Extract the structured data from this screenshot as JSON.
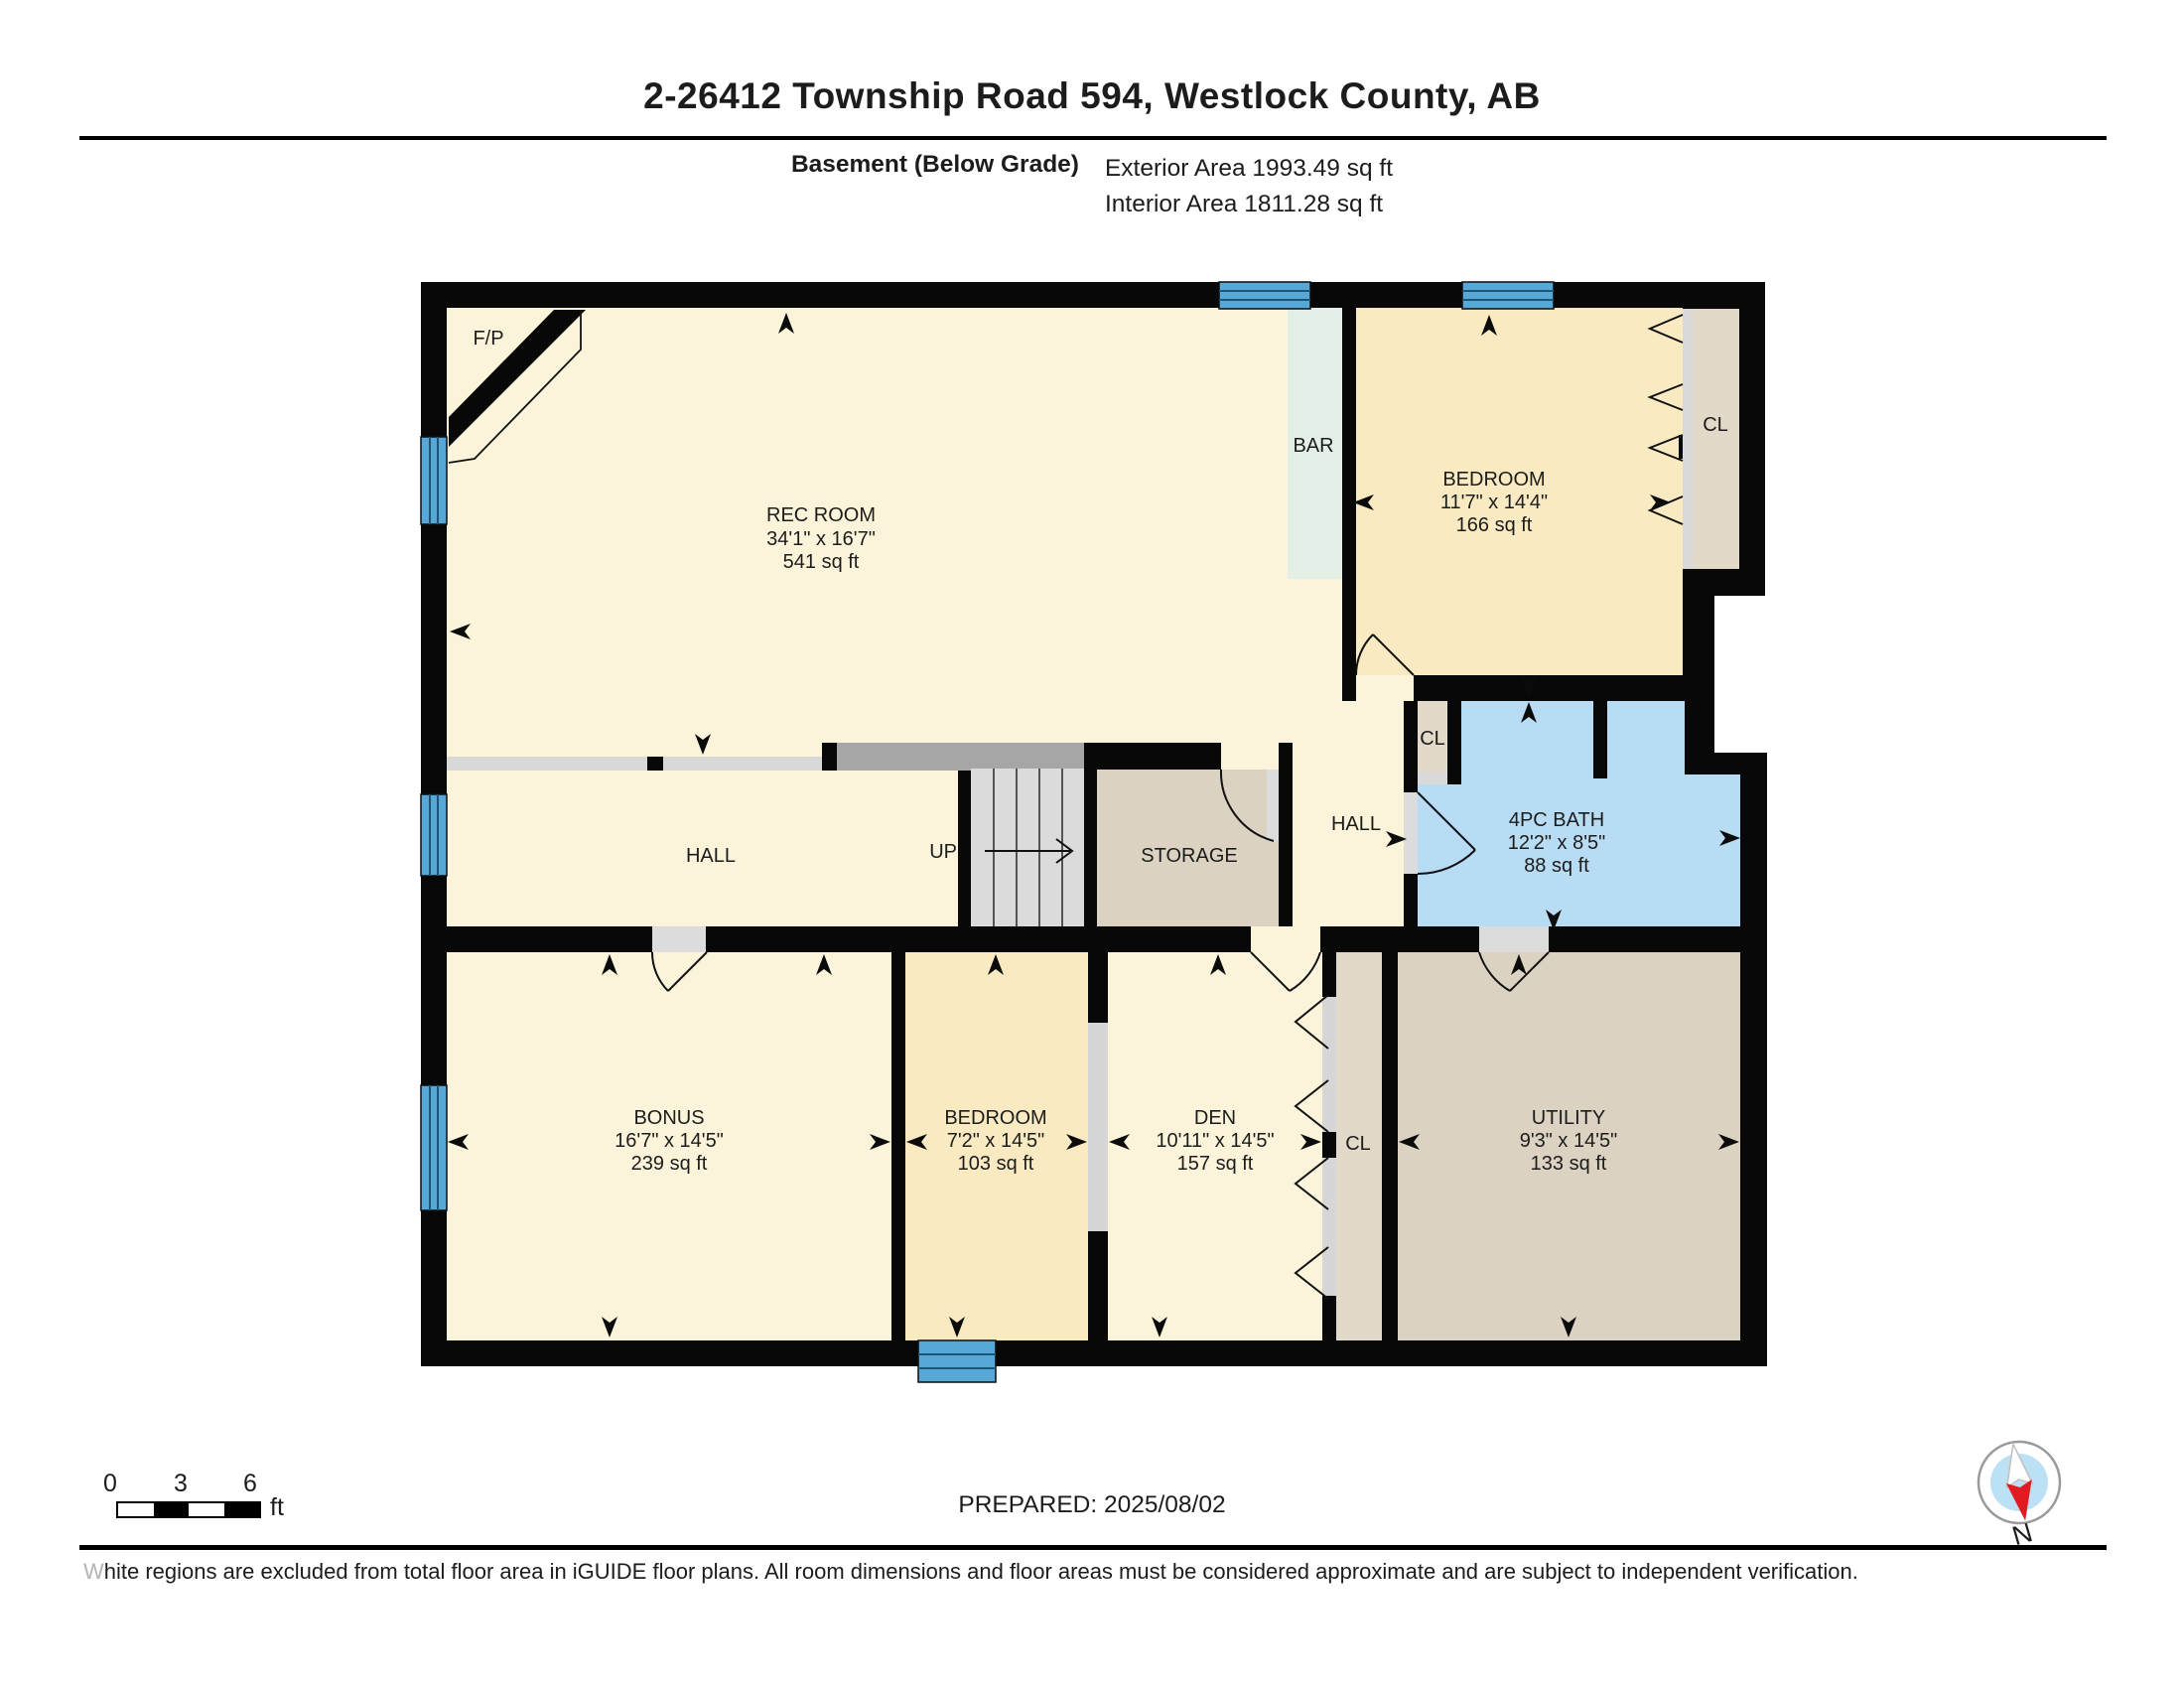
{
  "header": {
    "title": "2-26412 Township Road 594, Westlock County, AB",
    "floor_label": "Basement (Below Grade)",
    "exterior_area": "Exterior Area 1993.49 sq ft",
    "interior_area": "Interior Area 1811.28 sq ft"
  },
  "plan": {
    "rooms": [
      {
        "name": "REC ROOM",
        "dims": "34'1\" x 16'7\"",
        "area": "541 sq ft"
      },
      {
        "name": "BEDROOM",
        "dims": "11'7\" x 14'4\"",
        "area": "166 sq ft"
      },
      {
        "name": "4PC BATH",
        "dims": "12'2\" x 8'5\"",
        "area": "88 sq ft"
      },
      {
        "name": "BONUS",
        "dims": "16'7\" x 14'5\"",
        "area": "239 sq ft"
      },
      {
        "name": "BEDROOM",
        "dims": "7'2\" x 14'5\"",
        "area": "103 sq ft"
      },
      {
        "name": "DEN",
        "dims": "10'11\" x 14'5\"",
        "area": "157 sq ft"
      },
      {
        "name": "UTILITY",
        "dims": "9'3\" x 14'5\"",
        "area": "133 sq ft"
      }
    ],
    "labels": {
      "fireplace": "F/P",
      "bar": "BAR",
      "hall": "HALL",
      "hall2": "HALL",
      "up": "UP",
      "storage": "STORAGE",
      "closet": "CL"
    },
    "colors": {
      "wall": "#080808",
      "cream": "#FBF4DA",
      "bedroom": "#FAEAC2",
      "tan": "#DCD2C2",
      "closet_tan": "#E3D9C8",
      "bar_green": "#E4EFE8",
      "bath_blue": "#B7DCF3",
      "window_blue": "#57A8D6"
    }
  },
  "footer": {
    "scale": {
      "t0": "0",
      "t3": "3",
      "t6": "6",
      "unit": "ft"
    },
    "prepared": "PREPARED: 2025/08/02",
    "compass": "N",
    "disclaimer": "White regions are excluded from total floor area in iGUIDE floor plans. All room dimensions and floor areas must be considered approximate and are subject to independent verification."
  }
}
